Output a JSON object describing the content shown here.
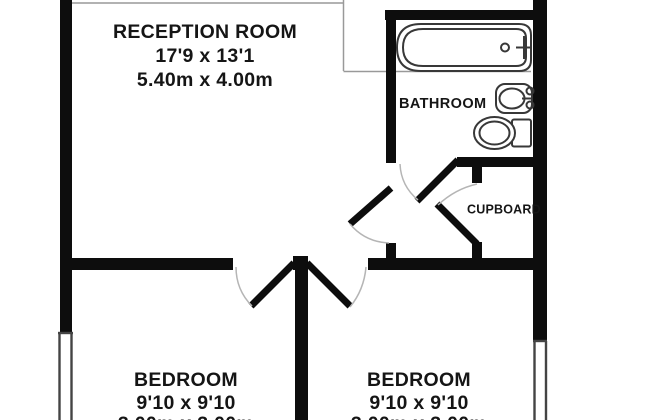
{
  "plan": {
    "type": "floor-plan",
    "rooms": {
      "reception": {
        "name": "RECEPTION ROOM",
        "size_imperial": "17'9 x 13'1",
        "size_metric": "5.40m x 4.00m"
      },
      "bathroom": {
        "name": "BATHROOM"
      },
      "cupboard": {
        "name": "CUPBOARD"
      },
      "bedroom_left": {
        "name": "BEDROOM",
        "size_imperial": "9'10 x 9'10",
        "size_metric": "3.00m x 3.00m"
      },
      "bedroom_right": {
        "name": "BEDROOM",
        "size_imperial": "9'10 x 9'10",
        "size_metric": "3.00m x 3.00m"
      }
    },
    "fixtures": [
      "bathtub",
      "washbasin",
      "toilet"
    ],
    "counts": {
      "doors": 5,
      "windows": 2
    },
    "colors": {
      "wall": "#0d0d0d",
      "fixture_line": "#383838",
      "door_swing_arc": "#b5b5b5",
      "text": "#151515",
      "background": "#ffffff"
    }
  }
}
